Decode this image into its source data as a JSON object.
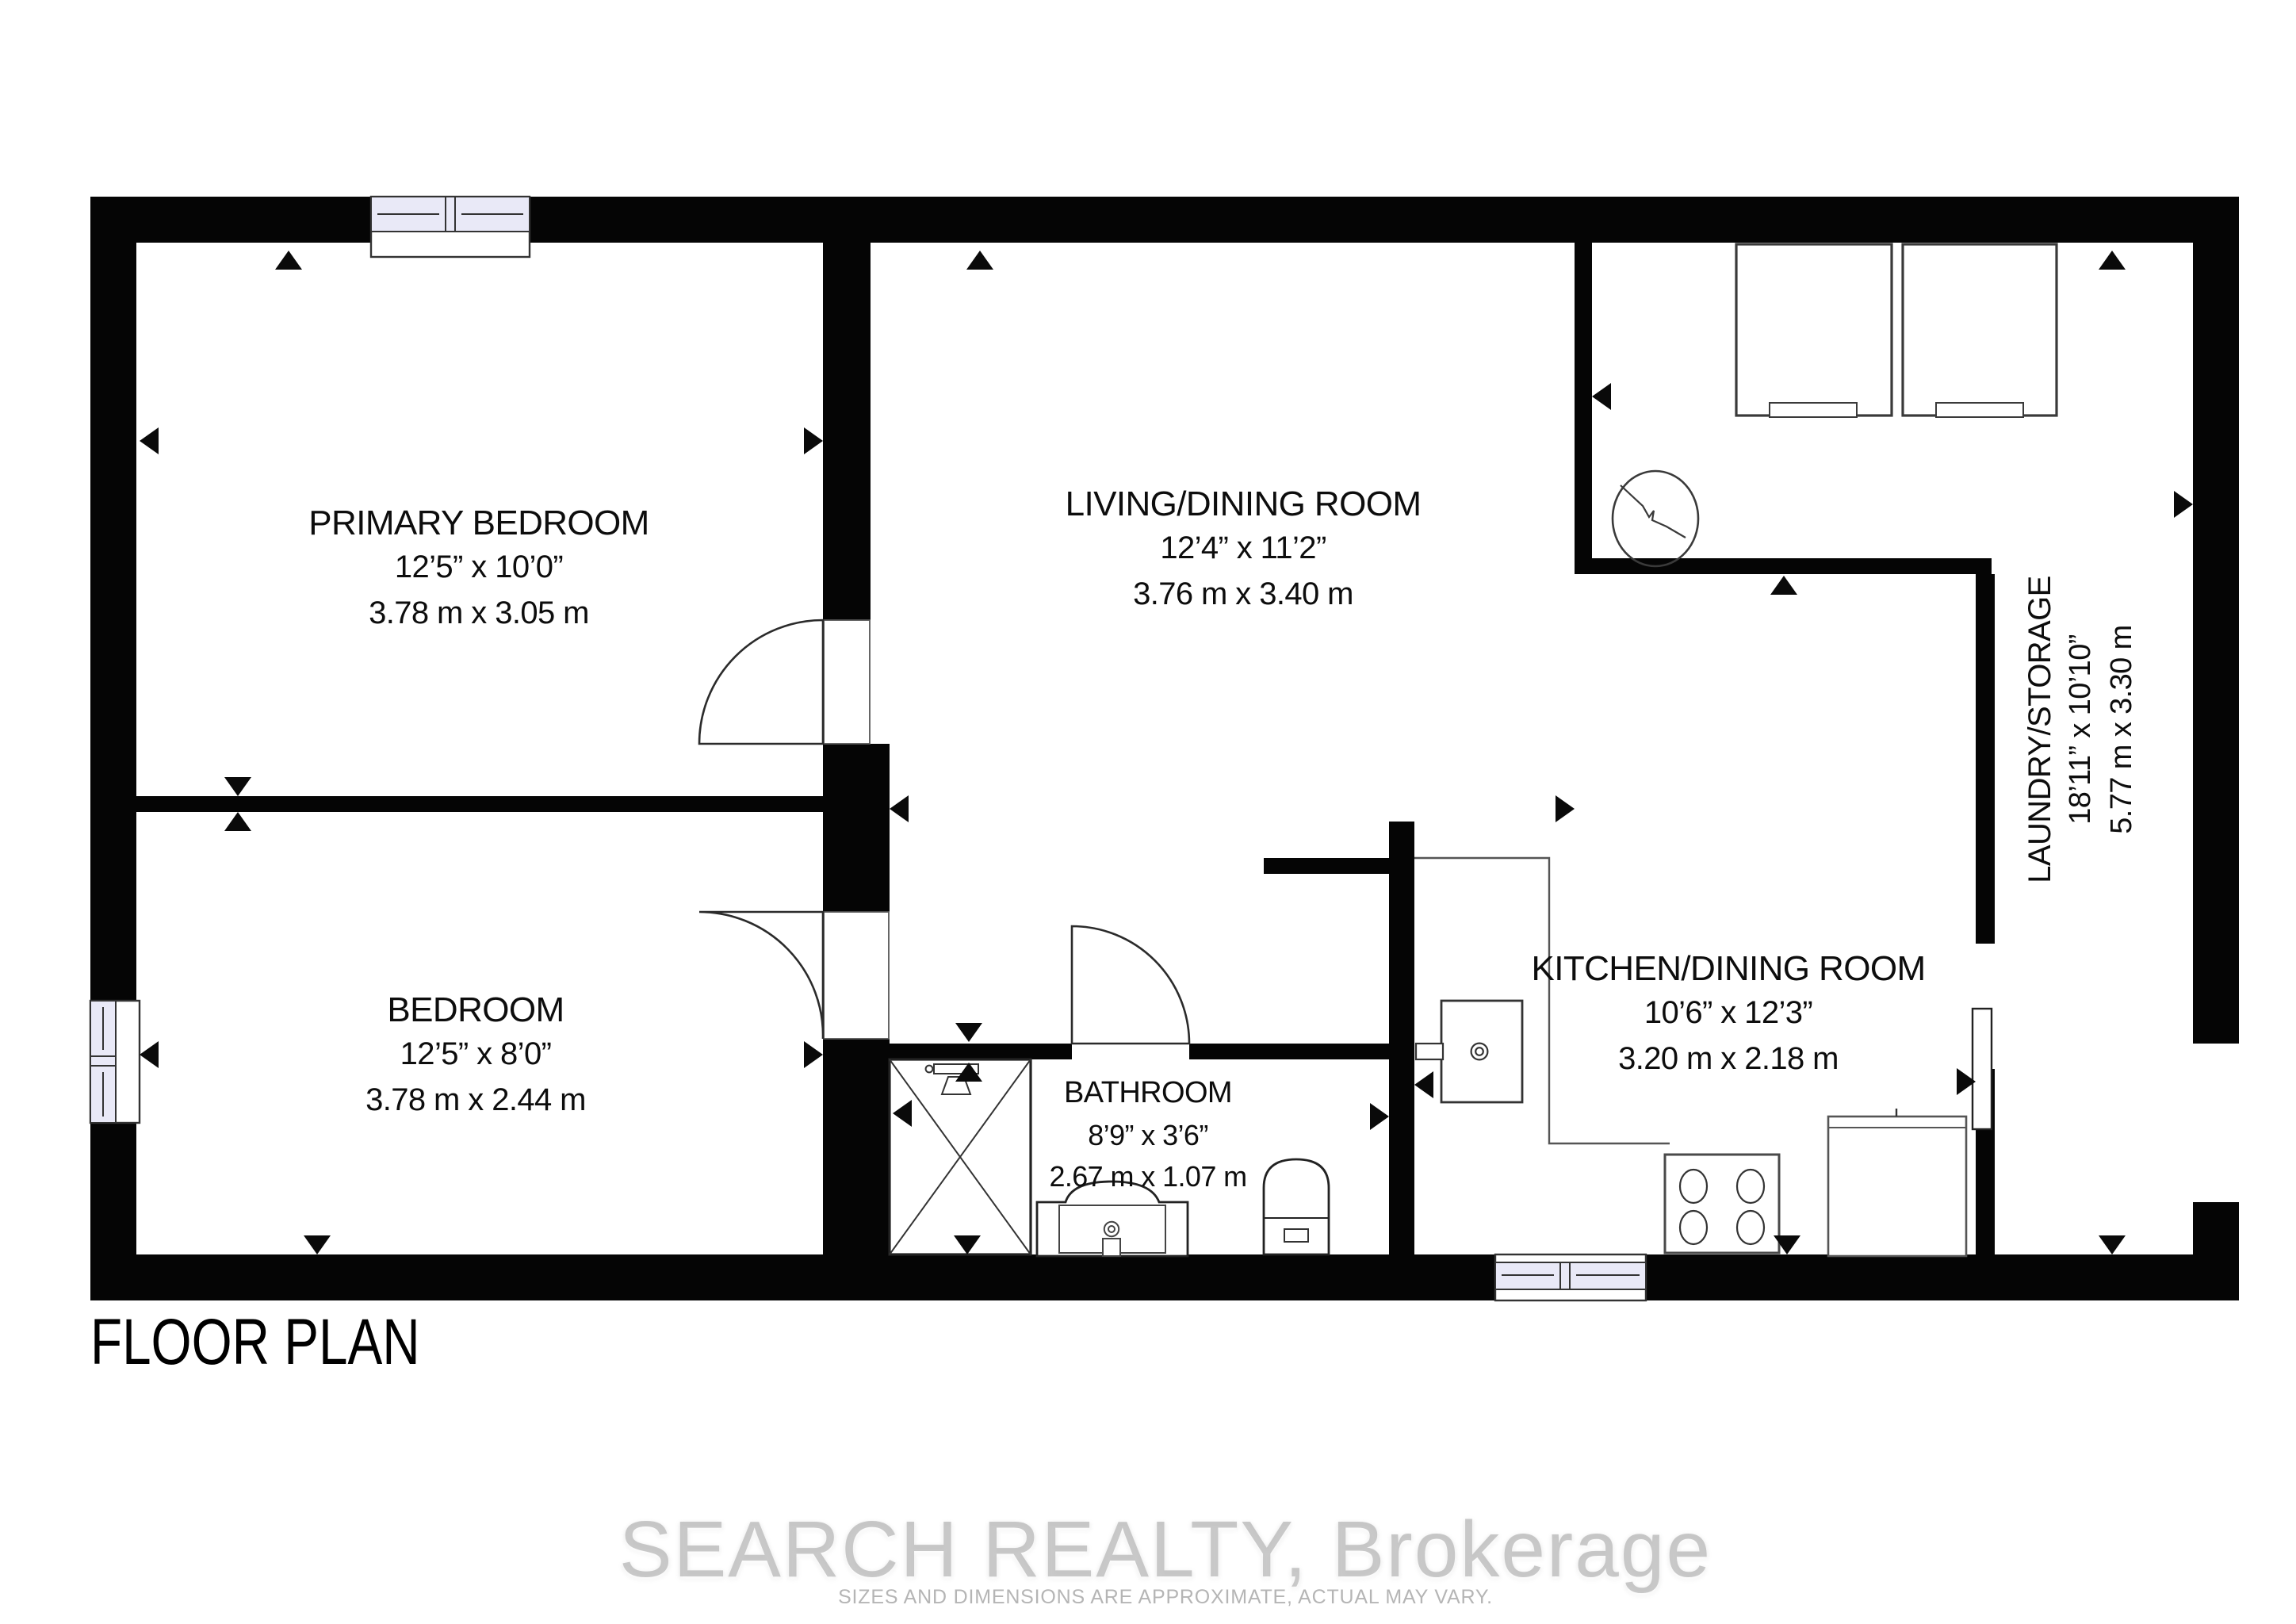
{
  "floor_plan": {
    "title": "FLOOR PLAN",
    "rooms": [
      {
        "name": "PRIMARY BEDROOM",
        "imperial": "12’5” x 10’0”",
        "metric": "3.78 m x 3.05 m"
      },
      {
        "name": "LIVING/DINING ROOM",
        "imperial": "12’4” x 11’2”",
        "metric": "3.76 m x 3.40 m"
      },
      {
        "name": "BEDROOM",
        "imperial": "12’5” x 8’0”",
        "metric": "3.78 m x 2.44 m"
      },
      {
        "name": "BATHROOM",
        "imperial": "8’9” x 3’6”",
        "metric": "2.67 m x 1.07 m"
      },
      {
        "name": "KITCHEN/DINING ROOM",
        "imperial": "10’6” x 12’3”",
        "metric": "3.20 m x 2.18 m"
      },
      {
        "name": "LAUNDRY/STORAGE",
        "imperial": "18’11” x 10’10”",
        "metric": "5.77 m x 3.30 m"
      }
    ],
    "colors": {
      "wall": "#050505",
      "window_glass": "#e9e9f7",
      "fixture_line": "#333333"
    }
  },
  "watermark": {
    "brand": "SEARCH REALTY, Brokerage",
    "disclaimer": "SIZES AND DIMENSIONS ARE APPROXIMATE, ACTUAL MAY VARY."
  }
}
